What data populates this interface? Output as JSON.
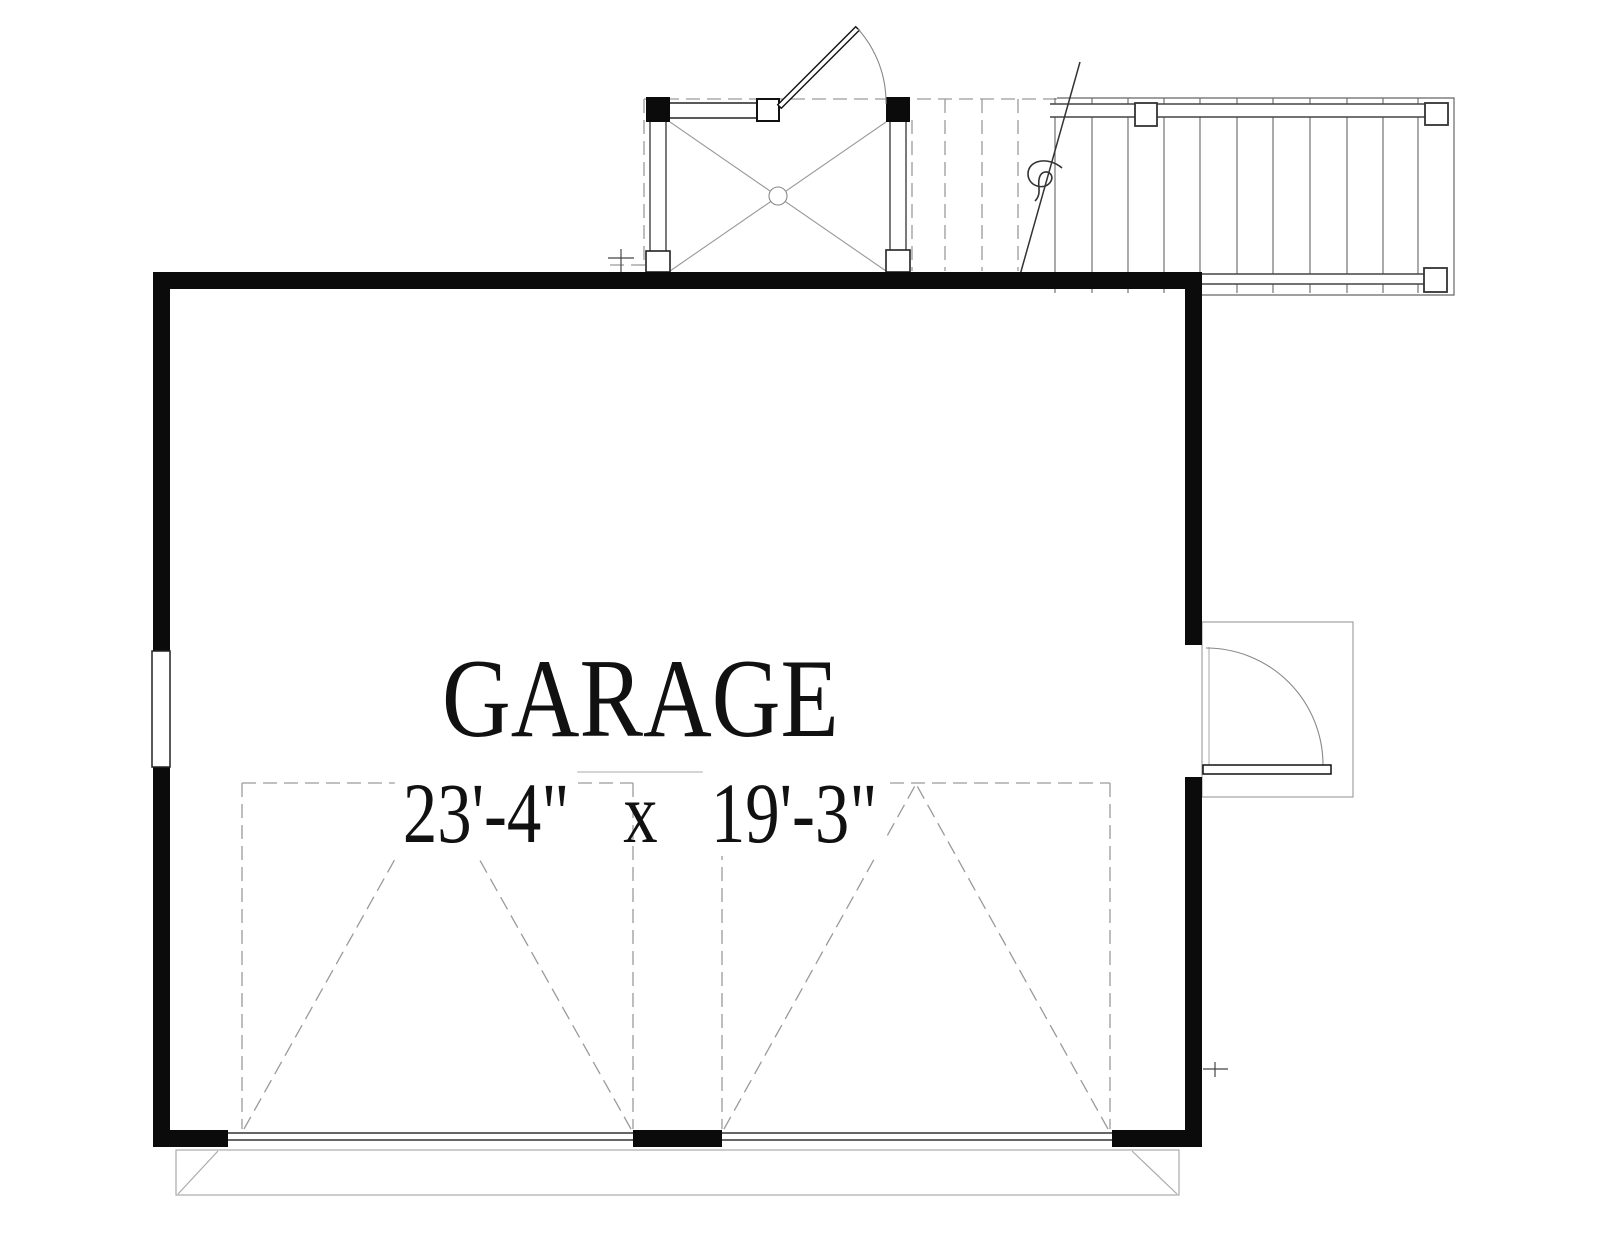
{
  "plan": {
    "room_label": "GARAGE",
    "dimension_width": "23'-4\"",
    "dimension_separator": "x",
    "dimension_height": "19'-3\""
  },
  "colors": {
    "wall": "#0b0b0b",
    "line_dark": "#333333",
    "line_medium": "#666666",
    "line_light": "#9a9a9a",
    "apron_line": "#aaaaaa",
    "text": "#111111",
    "background": "#ffffff"
  }
}
